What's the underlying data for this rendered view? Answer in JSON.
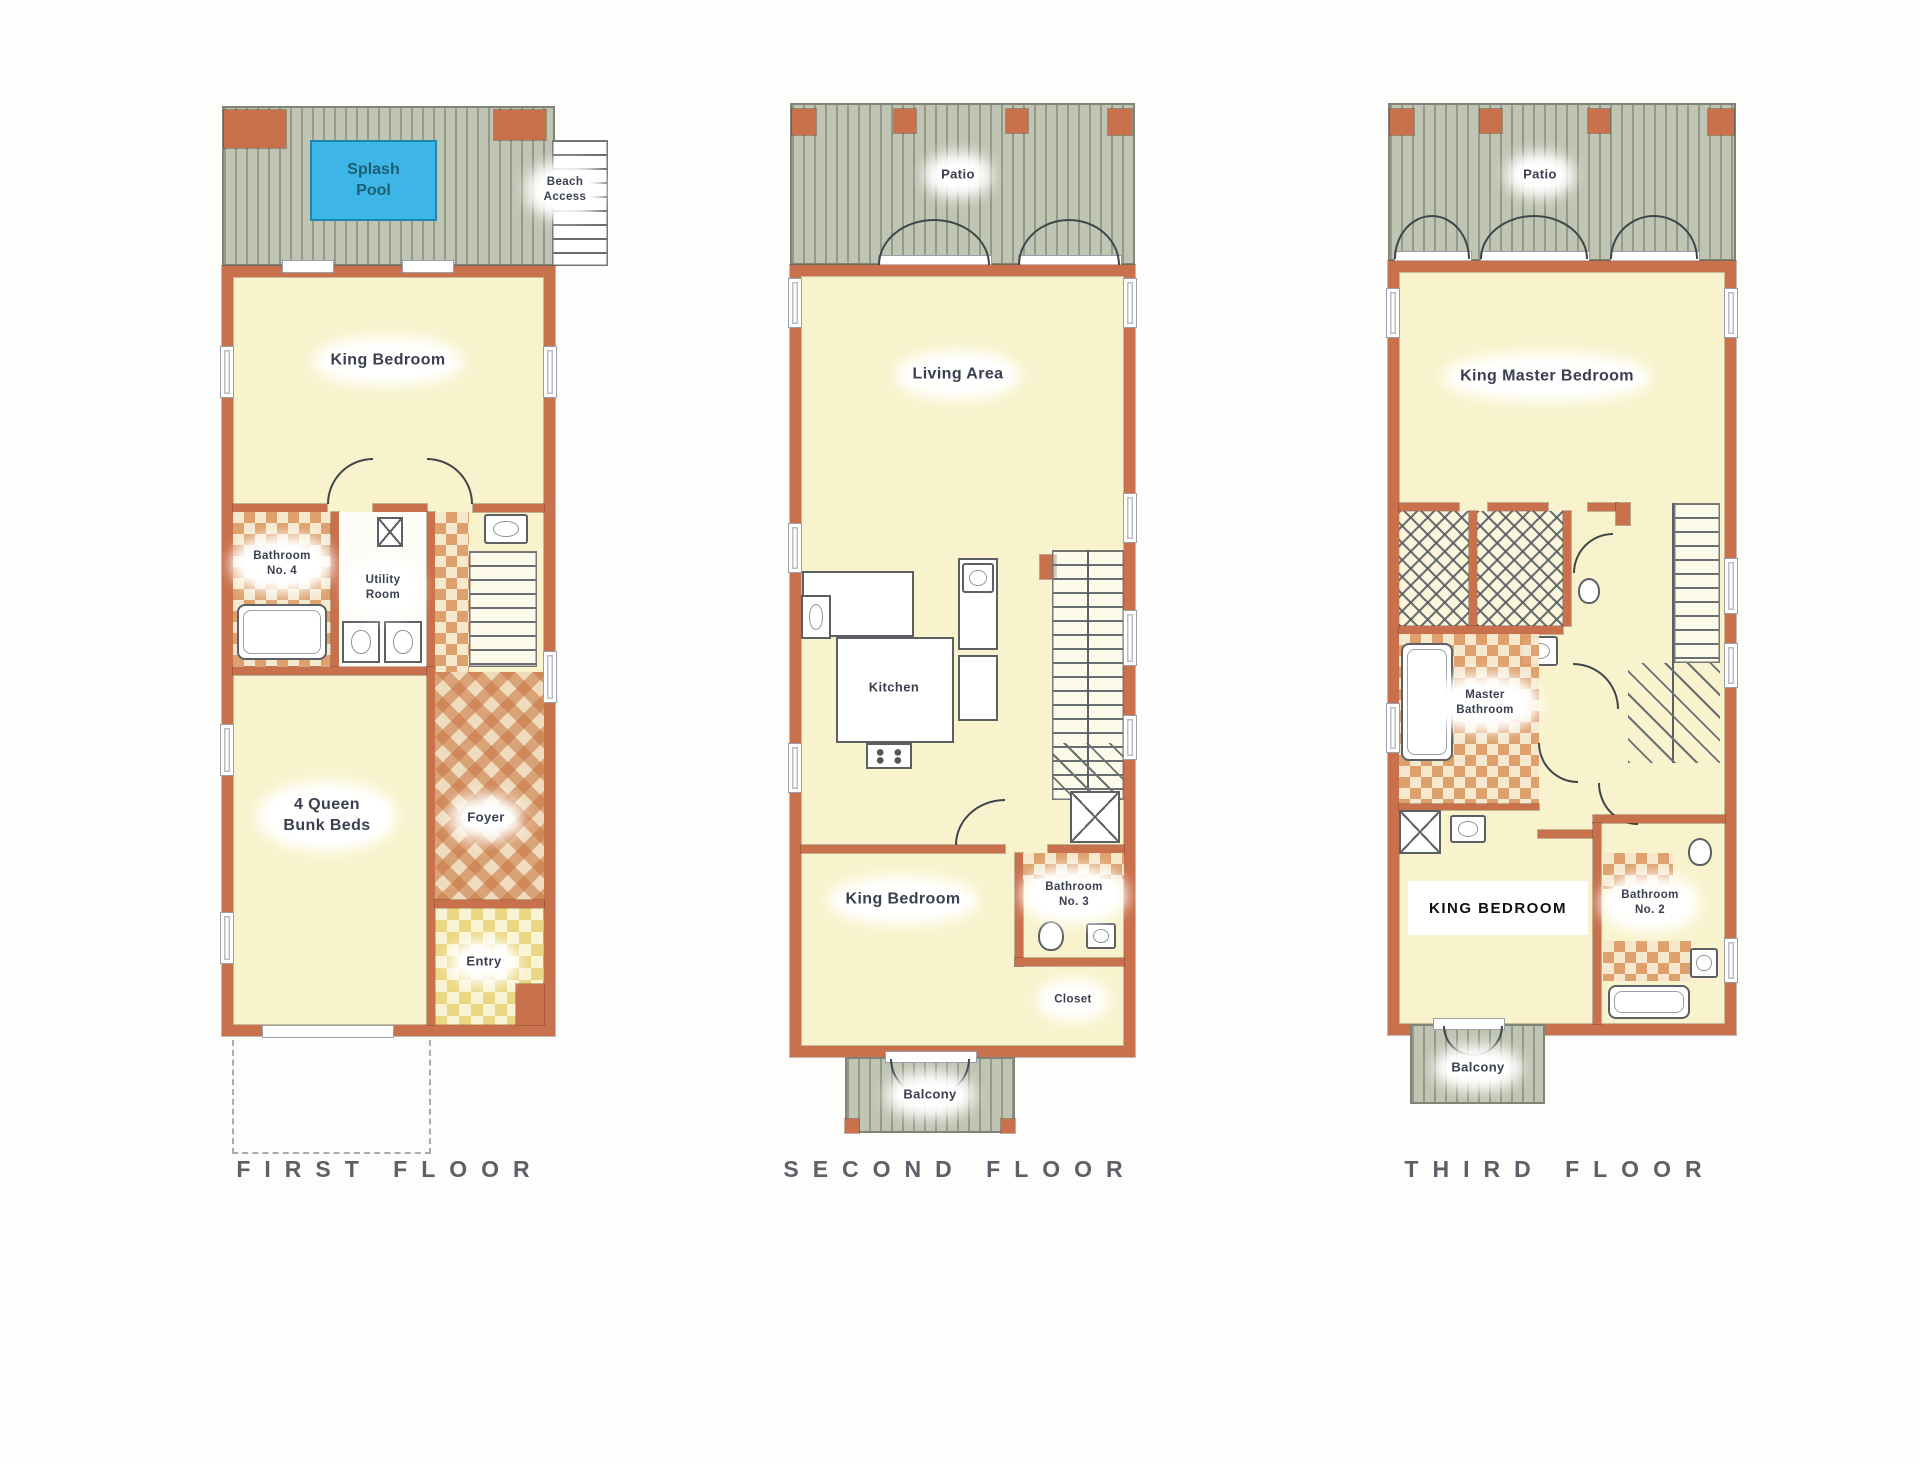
{
  "colors": {
    "wall": "#c9714d",
    "floor": "#f8f3cc",
    "deck": "#c0c5b3",
    "pool": "#3db5e6",
    "poolText": "#1d5e74",
    "tile": "#dd9d68",
    "tileBg": "#f5e7cd",
    "ytile": "#ead783",
    "ytileBg": "#faf3d3",
    "label": "#3b4050",
    "title": "#5d6167"
  },
  "floors": {
    "first": {
      "title": "FIRST FLOOR",
      "rooms": {
        "splash_pool": "Splash Pool",
        "beach_access": "Beach Access",
        "king_bedroom": "King Bedroom",
        "bathroom4": "Bathroom No. 4",
        "utility": "Utility Room",
        "bunk": "4 Queen Bunk Beds",
        "foyer": "Foyer",
        "entry": "Entry"
      }
    },
    "second": {
      "title": "SECOND FLOOR",
      "rooms": {
        "patio": "Patio",
        "living": "Living Area",
        "kitchen": "Kitchen",
        "king_bedroom": "King Bedroom",
        "bathroom3": "Bathroom No. 3",
        "closet": "Closet",
        "balcony": "Balcony"
      }
    },
    "third": {
      "title": "THIRD FLOOR",
      "rooms": {
        "patio": "Patio",
        "master_bedroom": "King Master Bedroom",
        "master_bath": "Master Bathroom",
        "king_bedroom": "KING BEDROOM",
        "bathroom2": "Bathroom No. 2",
        "balcony": "Balcony"
      }
    }
  }
}
